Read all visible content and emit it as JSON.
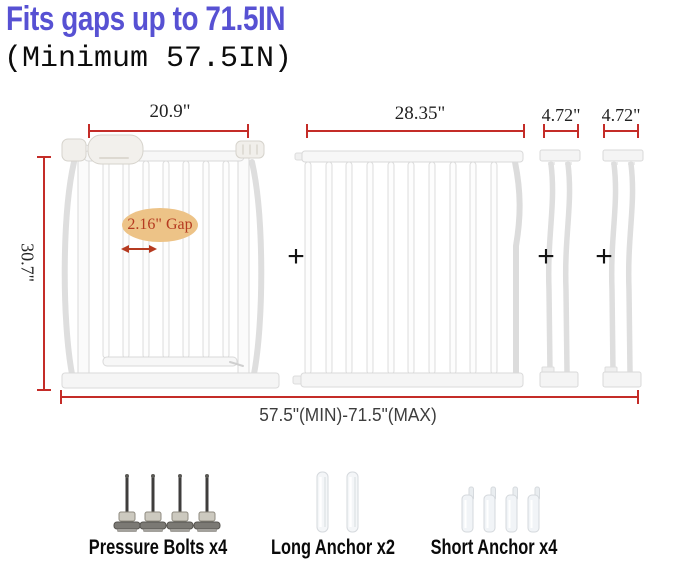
{
  "header": {
    "title": "Fits gaps up to 71.5IN",
    "subtitle": "(Minimum 57.5IN)"
  },
  "diagram": {
    "gate_width_label": "20.9\"",
    "extension_width_label": "28.35\"",
    "small_extension_1_label": "4.72\"",
    "small_extension_2_label": "4.72\"",
    "height_label": "30.7\"",
    "gap_callout": "2.16\" Gap",
    "total_width_label": "57.5\"(MIN)-71.5\"(MAX)",
    "plus_sign": "+"
  },
  "hardware": {
    "pressure_bolts": {
      "label": "Pressure Bolts x4",
      "count": 4
    },
    "long_anchor": {
      "label": "Long Anchor x2",
      "count": 2
    },
    "short_anchor": {
      "label": "Short Anchor x4",
      "count": 4
    }
  },
  "colors": {
    "title_blue": "#5751d3",
    "dimension_red": "#c42c28",
    "callout_fill": "#edc387",
    "callout_text": "#b53a20"
  }
}
